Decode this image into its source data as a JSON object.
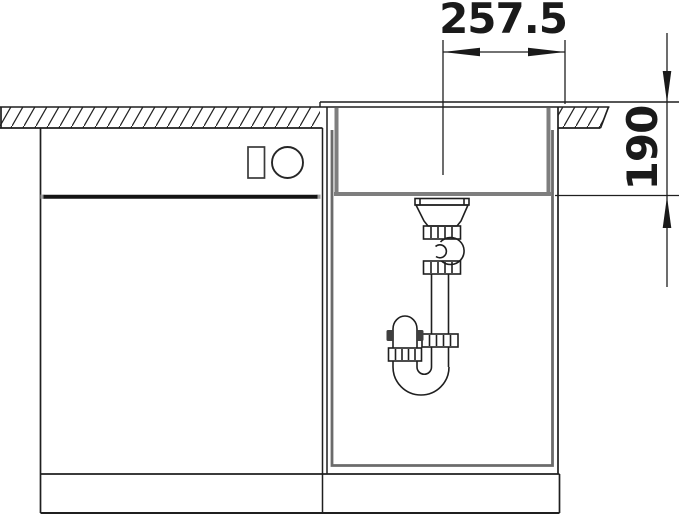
{
  "diagram": {
    "type": "technical-installation-drawing",
    "dimension_labels": {
      "width": "257.5",
      "depth": "190"
    },
    "colors": {
      "line": "#1f1f1f",
      "steel_gray": "#7e7e7e",
      "inner_cabinet_gray": "#6b6b6b",
      "background": "#ffffff"
    }
  }
}
